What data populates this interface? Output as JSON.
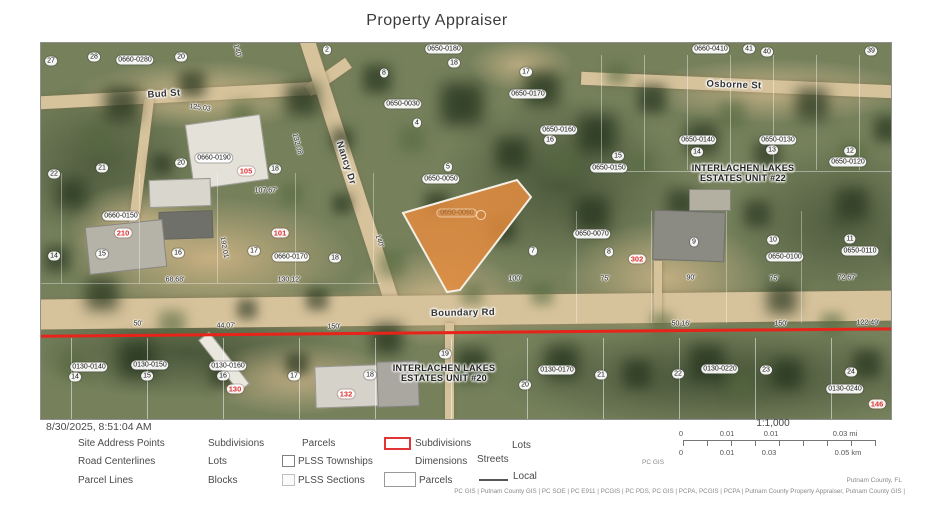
{
  "title": "Property Appraiser",
  "map": {
    "highlight_parcel": {
      "label": "0650-0060",
      "points": "362,170 476,137 490,154 419,247 406,249",
      "dot_x": 440,
      "dot_y": 172,
      "fill": "#e38c40",
      "stroke": "#f5f0e6"
    },
    "red_line_color": "#e8231a",
    "streets": [
      {
        "t": "Bud St",
        "x": 123,
        "y": 51,
        "rot": -4
      },
      {
        "t": "Nancy Dr",
        "x": 305,
        "y": 120,
        "rot": 72
      },
      {
        "t": "Osborne St",
        "x": 693,
        "y": 42,
        "rot": 2
      },
      {
        "t": "Boundary Rd",
        "x": 422,
        "y": 270,
        "rot": -1
      }
    ],
    "subdivision_names": [
      {
        "t": "INTERLACHEN LAKES\nESTATES UNIT #22",
        "x": 702,
        "y": 130
      },
      {
        "t": "INTERLACHEN LAKES\nESTATES UNIT #20",
        "x": 403,
        "y": 330
      }
    ],
    "parcel_pills": [
      {
        "t": "27",
        "x": 10,
        "y": 18
      },
      {
        "t": "28",
        "x": 53,
        "y": 14
      },
      {
        "t": "0660-0280",
        "x": 94,
        "y": 17
      },
      {
        "t": "20",
        "x": 140,
        "y": 14
      },
      {
        "t": "2",
        "x": 286,
        "y": 7
      },
      {
        "t": "0650-0180",
        "x": 403,
        "y": 6
      },
      {
        "t": "18",
        "x": 413,
        "y": 20
      },
      {
        "t": "0660-0410",
        "x": 670,
        "y": 6
      },
      {
        "t": "41",
        "x": 708,
        "y": 6
      },
      {
        "t": "40",
        "x": 726,
        "y": 9
      },
      {
        "t": "39",
        "x": 830,
        "y": 8
      },
      {
        "t": "8",
        "x": 343,
        "y": 30
      },
      {
        "t": "17",
        "x": 485,
        "y": 29
      },
      {
        "t": "0650-0170",
        "x": 487,
        "y": 51
      },
      {
        "t": "0650-0030",
        "x": 362,
        "y": 61
      },
      {
        "t": "4",
        "x": 376,
        "y": 80
      },
      {
        "t": "0650-0160",
        "x": 518,
        "y": 87
      },
      {
        "t": "16",
        "x": 509,
        "y": 97
      },
      {
        "t": "15",
        "x": 577,
        "y": 113
      },
      {
        "t": "0650-0150",
        "x": 568,
        "y": 125
      },
      {
        "t": "5",
        "x": 407,
        "y": 124
      },
      {
        "t": "0650-0050",
        "x": 400,
        "y": 136
      },
      {
        "t": "0650-0140",
        "x": 657,
        "y": 97
      },
      {
        "t": "14",
        "x": 656,
        "y": 109
      },
      {
        "t": "0650-0130",
        "x": 737,
        "y": 97
      },
      {
        "t": "13",
        "x": 731,
        "y": 107
      },
      {
        "t": "12",
        "x": 809,
        "y": 108
      },
      {
        "t": "0650-0120",
        "x": 807,
        "y": 119
      },
      {
        "t": "0660-0190",
        "x": 173,
        "y": 115
      },
      {
        "t": "20",
        "x": 140,
        "y": 120
      },
      {
        "t": "18",
        "x": 234,
        "y": 126
      },
      {
        "t": "21",
        "x": 61,
        "y": 125
      },
      {
        "t": "22",
        "x": 13,
        "y": 131
      },
      {
        "t": "0660-0150",
        "x": 80,
        "y": 173
      },
      {
        "t": "15",
        "x": 61,
        "y": 211
      },
      {
        "t": "16",
        "x": 137,
        "y": 210
      },
      {
        "t": "17",
        "x": 213,
        "y": 208
      },
      {
        "t": "0660-0170",
        "x": 250,
        "y": 214
      },
      {
        "t": "18",
        "x": 294,
        "y": 215
      },
      {
        "t": "14",
        "x": 13,
        "y": 213
      },
      {
        "t": "7",
        "x": 492,
        "y": 208
      },
      {
        "t": "0650-0070",
        "x": 551,
        "y": 191
      },
      {
        "t": "8",
        "x": 568,
        "y": 209
      },
      {
        "t": "9",
        "x": 653,
        "y": 199
      },
      {
        "t": "10",
        "x": 732,
        "y": 197
      },
      {
        "t": "0650-0100",
        "x": 744,
        "y": 214
      },
      {
        "t": "11",
        "x": 809,
        "y": 196
      },
      {
        "t": "0650-0110",
        "x": 819,
        "y": 208
      },
      {
        "t": "0130-0140",
        "x": 48,
        "y": 324
      },
      {
        "t": "14",
        "x": 34,
        "y": 334
      },
      {
        "t": "0130-0150",
        "x": 109,
        "y": 322
      },
      {
        "t": "15",
        "x": 106,
        "y": 333
      },
      {
        "t": "0130-0160",
        "x": 187,
        "y": 323
      },
      {
        "t": "16",
        "x": 182,
        "y": 333
      },
      {
        "t": "17",
        "x": 253,
        "y": 333
      },
      {
        "t": "18",
        "x": 329,
        "y": 332
      },
      {
        "t": "19",
        "x": 404,
        "y": 311
      },
      {
        "t": "20",
        "x": 484,
        "y": 342
      },
      {
        "t": "0130-0170",
        "x": 516,
        "y": 327
      },
      {
        "t": "21",
        "x": 560,
        "y": 332
      },
      {
        "t": "22",
        "x": 637,
        "y": 331
      },
      {
        "t": "0130-0220",
        "x": 679,
        "y": 326
      },
      {
        "t": "23",
        "x": 725,
        "y": 327
      },
      {
        "t": "24",
        "x": 810,
        "y": 329
      },
      {
        "t": "0130-0240",
        "x": 804,
        "y": 346
      }
    ],
    "address_points": [
      {
        "t": "105",
        "x": 205,
        "y": 128
      },
      {
        "t": "210",
        "x": 82,
        "y": 190
      },
      {
        "t": "101",
        "x": 239,
        "y": 190
      },
      {
        "t": "302",
        "x": 596,
        "y": 216
      },
      {
        "t": "130",
        "x": 194,
        "y": 346
      },
      {
        "t": "132",
        "x": 305,
        "y": 351
      },
      {
        "t": "146",
        "x": 836,
        "y": 361
      }
    ],
    "dimensions": [
      {
        "t": "125.03",
        "x": 159,
        "y": 65,
        "rot": 8
      },
      {
        "t": "140'",
        "x": 196,
        "y": 8,
        "rot": 75
      },
      {
        "t": "132.38",
        "x": 256,
        "y": 101,
        "rot": 75
      },
      {
        "t": "107.67'",
        "x": 225,
        "y": 148
      },
      {
        "t": "192.01'",
        "x": 183,
        "y": 205,
        "rot": 80
      },
      {
        "t": "68.68'",
        "x": 134,
        "y": 237
      },
      {
        "t": "130.12'",
        "x": 248,
        "y": 237
      },
      {
        "t": "140'",
        "x": 338,
        "y": 198,
        "rot": 72
      },
      {
        "t": "100'",
        "x": 474,
        "y": 236
      },
      {
        "t": "75'",
        "x": 564,
        "y": 236
      },
      {
        "t": "90'",
        "x": 650,
        "y": 235
      },
      {
        "t": "75'",
        "x": 733,
        "y": 236
      },
      {
        "t": "72.67'",
        "x": 806,
        "y": 235
      },
      {
        "t": "50'",
        "x": 97,
        "y": 281
      },
      {
        "t": "44.07'",
        "x": 185,
        "y": 283
      },
      {
        "t": "150'",
        "x": 293,
        "y": 284
      },
      {
        "t": "50.16'",
        "x": 640,
        "y": 281
      },
      {
        "t": "150'",
        "x": 740,
        "y": 281
      },
      {
        "t": "122.49'",
        "x": 827,
        "y": 280
      }
    ]
  },
  "footer": {
    "timestamp": "8/30/2025, 8:51:04 AM",
    "legend_rows": [
      {
        "cells": [
          {
            "label": "Site Address Points"
          },
          {
            "label": "Subdivisions"
          },
          {
            "label": "Parcels"
          },
          {
            "icon": "red-rectangle",
            "label": "Subdivisions"
          },
          {
            "label": "Lots"
          }
        ]
      },
      {
        "cells": [
          {
            "label": "Road Centerlines"
          },
          {
            "label": "Lots"
          },
          {
            "icon": "checkbox",
            "label": "PLSS Townships"
          },
          {
            "label": "Dimensions"
          },
          {
            "label": "Streets"
          }
        ]
      },
      {
        "cells": [
          {
            "label": "Parcel Lines"
          },
          {
            "label": "Blocks"
          },
          {
            "icon": "checkbox",
            "label": "PLSS Sections"
          },
          {
            "icon": "white-rectangle",
            "label": "Parcels"
          },
          {
            "icon": "line",
            "label": "Local"
          }
        ]
      }
    ],
    "scale": {
      "ratio": "1:1,000",
      "mi": [
        "0",
        "0.01",
        "0.01",
        "0.03 mi"
      ],
      "km": [
        "0",
        "0.01",
        "0.03",
        "0.05 km"
      ]
    },
    "credit_small": "PC GIS",
    "credit_right": "Putnam County, FL",
    "attribution": "PC GIS | Putnam County GIS | PC SOE | PC E911 | PCGIS | PC PDS, PC GIS | PCPA, PCGIS | PCPA | Putnam County Property Appraiser, Putnam County GIS |"
  }
}
